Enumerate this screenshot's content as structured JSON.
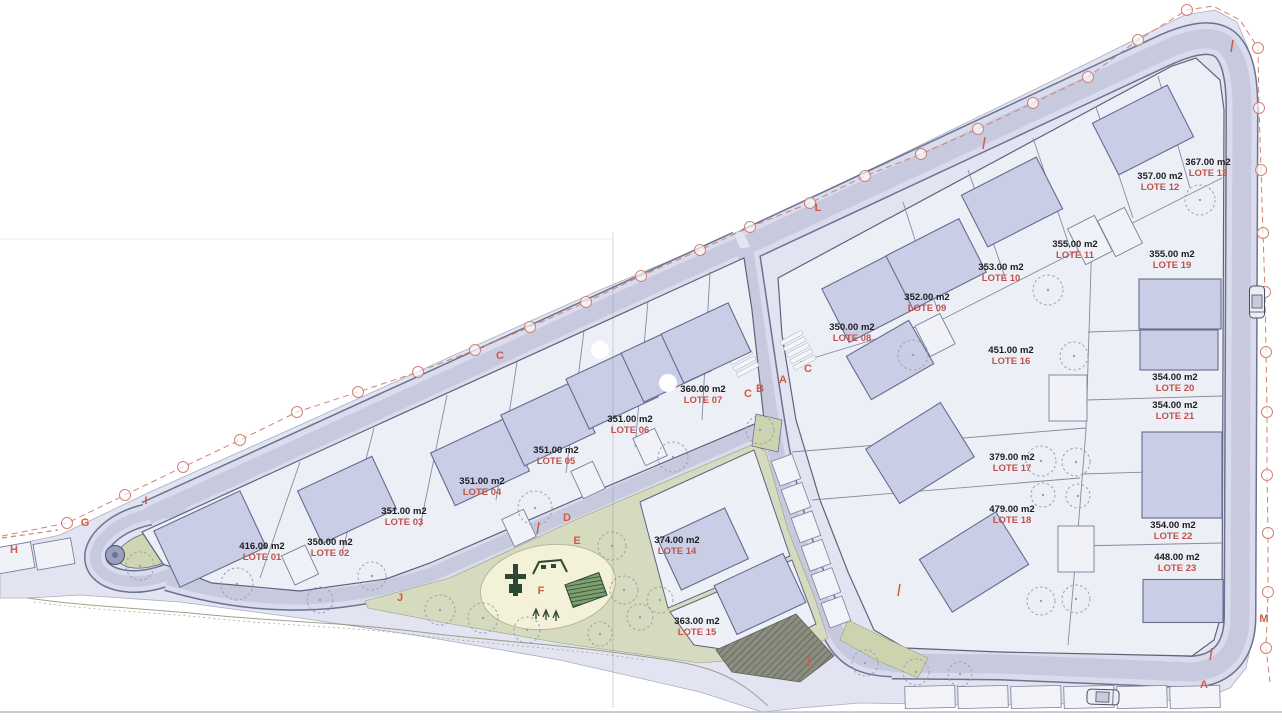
{
  "plan": {
    "lots": [
      {
        "lote": "LOTE 01",
        "area": "416.00 m2",
        "x": 262,
        "y": 549
      },
      {
        "lote": "LOTE 02",
        "area": "350.00 m2",
        "x": 330,
        "y": 545
      },
      {
        "lote": "LOTE 03",
        "area": "351.00 m2",
        "x": 404,
        "y": 514
      },
      {
        "lote": "LOTE 04",
        "area": "351.00 m2",
        "x": 482,
        "y": 484
      },
      {
        "lote": "LOTE 05",
        "area": "351.00 m2",
        "x": 556,
        "y": 453
      },
      {
        "lote": "LOTE 06",
        "area": "351.00 m2",
        "x": 630,
        "y": 422
      },
      {
        "lote": "LOTE 07",
        "area": "360.00 m2",
        "x": 703,
        "y": 392
      },
      {
        "lote": "LOTE 08",
        "area": "350.00 m2",
        "x": 852,
        "y": 330
      },
      {
        "lote": "LOTE 09",
        "area": "352.00 m2",
        "x": 927,
        "y": 300
      },
      {
        "lote": "LOTE 10",
        "area": "353.00 m2",
        "x": 1001,
        "y": 270
      },
      {
        "lote": "LOTE 11",
        "area": "355.00 m2",
        "x": 1075,
        "y": 247
      },
      {
        "lote": "LOTE 12",
        "area": "357.00 m2",
        "x": 1160,
        "y": 179
      },
      {
        "lote": "LOTE 13",
        "area": "367.00 m2",
        "x": 1208,
        "y": 165
      },
      {
        "lote": "LOTE 14",
        "area": "374.00 m2",
        "x": 677,
        "y": 543
      },
      {
        "lote": "LOTE 15",
        "area": "363.00 m2",
        "x": 697,
        "y": 624
      },
      {
        "lote": "LOTE 16",
        "area": "451.00 m2",
        "x": 1011,
        "y": 353
      },
      {
        "lote": "LOTE 17",
        "area": "379.00 m2",
        "x": 1012,
        "y": 460
      },
      {
        "lote": "LOTE 18",
        "area": "479.00 m2",
        "x": 1012,
        "y": 512
      },
      {
        "lote": "LOTE 19",
        "area": "355.00 m2",
        "x": 1172,
        "y": 257
      },
      {
        "lote": "LOTE 20",
        "area": "354.00 m2",
        "x": 1175,
        "y": 380
      },
      {
        "lote": "LOTE 21",
        "area": "354.00 m2",
        "x": 1175,
        "y": 408
      },
      {
        "lote": "LOTE 22",
        "area": "354.00 m2",
        "x": 1173,
        "y": 528
      },
      {
        "lote": "LOTE 23",
        "area": "448.00 m2",
        "x": 1177,
        "y": 560
      }
    ],
    "road_letters": [
      {
        "char": "H",
        "x": 14,
        "y": 553
      },
      {
        "char": "G",
        "x": 85,
        "y": 526
      },
      {
        "char": "I",
        "x": 146,
        "y": 504
      },
      {
        "char": "C",
        "x": 500,
        "y": 359
      },
      {
        "char": "D",
        "x": 567,
        "y": 521
      },
      {
        "char": "E",
        "x": 577,
        "y": 544
      },
      {
        "char": "F",
        "x": 541,
        "y": 594,
        "size": 15
      },
      {
        "char": "J",
        "x": 400,
        "y": 601
      },
      {
        "char": "C",
        "x": 748,
        "y": 397
      },
      {
        "char": "B",
        "x": 760,
        "y": 392
      },
      {
        "char": "A",
        "x": 783,
        "y": 383
      },
      {
        "char": "C",
        "x": 808,
        "y": 372
      },
      {
        "char": "L",
        "x": 818,
        "y": 211
      },
      {
        "char": "M",
        "x": 1264,
        "y": 622
      },
      {
        "char": "A",
        "x": 1204,
        "y": 688
      }
    ],
    "colors": {
      "area_text": "#1d1d1f",
      "lote_text": "#c0524b",
      "letter_text": "#d05a46",
      "boundary_line": "#cf8375",
      "road_fill": "#c7cadf",
      "sidewalk_fill": "#dadbec",
      "building_fill": "#c9cde5",
      "block_fill": "#edeff7",
      "park_fill": "#d6dabe",
      "playground_fill": "#f4f1d9"
    }
  }
}
